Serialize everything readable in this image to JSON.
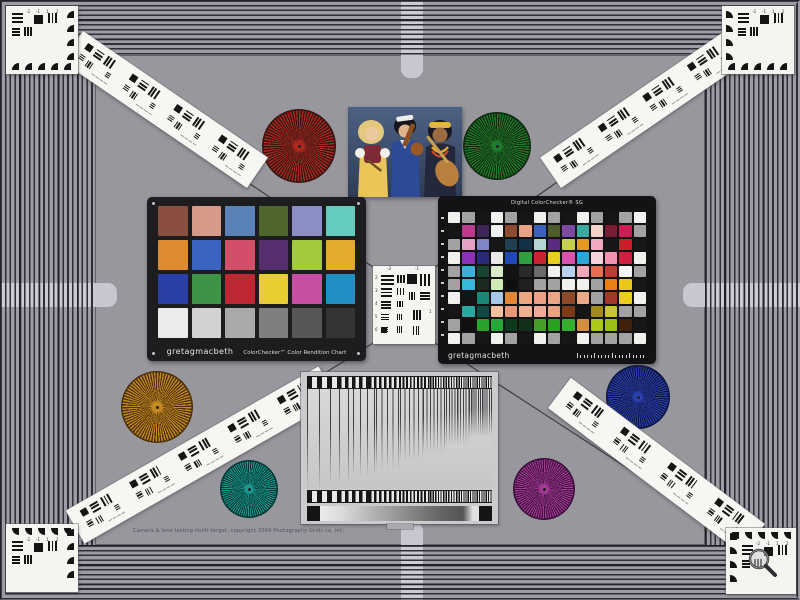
{
  "labels": {
    "cc_brand": "gretagmacbeth",
    "cc_title": "ColorChecker™ Color Rendition Chart",
    "sg_title": "Digital ColorChecker® SG",
    "sg_brand": "gretagmacbeth",
    "copyright": "Camera & lens testing multi-target, copyright 2004 Photography Grids.ca, inc."
  },
  "colors": {
    "field_bg": "#97979d",
    "stripe_dark": "#2e2e38",
    "stripe_light": "#9c9ca4",
    "cross_marker": "#c7c7cf",
    "card_black": "#1d1d1f",
    "guide_line": "#3c3c42"
  },
  "colorchecker": {
    "rows": 4,
    "cols": 6,
    "patches": [
      "#8a4f3f",
      "#d79a88",
      "#5a84b8",
      "#4e6629",
      "#8c8ec6",
      "#63cdbd",
      "#dd8b2e",
      "#3b63c0",
      "#d14f68",
      "#56306e",
      "#a3c93c",
      "#e3ab2c",
      "#2a3fa8",
      "#3d9447",
      "#bf2734",
      "#e8ce30",
      "#c94fa4",
      "#2090c4",
      "#ebebe9",
      "#d2d2d0",
      "#a9a9a9",
      "#7f7f7f",
      "#565656",
      "#343434"
    ]
  },
  "colorchecker_sg": {
    "rows": 10,
    "cols": 14,
    "patches": [
      [
        "#f0f0ec",
        "#a2a2a2",
        "#161616",
        "#f0f0ec",
        "#a2a2a2",
        "#161616",
        "#f0f0ec",
        "#a2a2a2",
        "#161616",
        "#f0f0ec",
        "#a2a2a2",
        "#161616",
        "#a2a2a2",
        "#f0f0ec"
      ],
      [
        "#161616",
        "#bc3a8e",
        "#402656",
        "#f0f0ec",
        "#8c4a2e",
        "#eaa286",
        "#3a62ba",
        "#505c2a",
        "#7c4aa0",
        "#3aaaa0",
        "#f2d2ca",
        "#7a1c34",
        "#cc1e54",
        "#a2a2a2"
      ],
      [
        "#a2a2a2",
        "#e2a2c6",
        "#7e86c8",
        "#161616",
        "#1e4050",
        "#123046",
        "#b6d6d6",
        "#5c2a82",
        "#c6d04a",
        "#e29a20",
        "#f0aac0",
        "#161616",
        "#d01c28",
        "#161616"
      ],
      [
        "#f0f0ec",
        "#8c32ba",
        "#2a2a7a",
        "#e8e8e4",
        "#2148b8",
        "#2ea042",
        "#c82430",
        "#e6d022",
        "#da52aa",
        "#2aa8d8",
        "#f8d2da",
        "#f092b2",
        "#d02042",
        "#f0f0ec"
      ],
      [
        "#a2a2a2",
        "#36b4d8",
        "#164430",
        "#d8eac6",
        "#121212",
        "#2a2a2a",
        "#6a6a6a",
        "#f0f0ec",
        "#b8d2ee",
        "#f2aab8",
        "#e87052",
        "#c03a30",
        "#f6f6f4",
        "#a2a2a2"
      ],
      [
        "#a2a2a2",
        "#38b8d8",
        "#1c2a20",
        "#d2e8b6",
        "#0e0e0e",
        "#202020",
        "#a2a2a2",
        "#a2a2a2",
        "#f0f0ec",
        "#f0f0ec",
        "#a2a2a2",
        "#e88018",
        "#e8c818",
        "#161616"
      ],
      [
        "#f0f0ec",
        "#141414",
        "#1a8878",
        "#a8c8e8",
        "#e08838",
        "#eca882",
        "#eca088",
        "#eca486",
        "#8c4a28",
        "#ecaa8a",
        "#a2a2a2",
        "#a23828",
        "#e8d018",
        "#f0f0ec"
      ],
      [
        "#161616",
        "#2aa8a0",
        "#0e4a42",
        "#f0c0a0",
        "#e89878",
        "#f0b090",
        "#f0a89a",
        "#eca080",
        "#7c3a18",
        "#161616",
        "#a28a1a",
        "#c8c62a",
        "#a2a2a2",
        "#a2a2a2"
      ],
      [
        "#a2a2a2",
        "#101010",
        "#2aa22e",
        "#28a83a",
        "#0c3a1a",
        "#12301a",
        "#46a028",
        "#28a020",
        "#32b02e",
        "#d29040",
        "#aac818",
        "#9ac018",
        "#40200e",
        "#161616"
      ],
      [
        "#f0f0ec",
        "#a2a2a2",
        "#161616",
        "#f0f0ec",
        "#a2a2a2",
        "#161616",
        "#f0f0ec",
        "#a2a2a2",
        "#161616",
        "#f0f0ec",
        "#a2a2a2",
        "#a2a2a2",
        "#a2a2a2",
        "#f0f0ec"
      ]
    ]
  },
  "stars": [
    {
      "name": "star-red",
      "cx": 299,
      "cy": 146,
      "r": 37,
      "color": "#aa2820",
      "dark": "#331410"
    },
    {
      "name": "star-green",
      "cx": 497,
      "cy": 146,
      "r": 34,
      "color": "#1f7d2c",
      "dark": "#10280e"
    },
    {
      "name": "star-orange",
      "cx": 157,
      "cy": 407,
      "r": 36,
      "color": "#c58a22",
      "dark": "#4a3008"
    },
    {
      "name": "star-teal",
      "cx": 249,
      "cy": 489,
      "r": 29,
      "color": "#189a90",
      "dark": "#073430"
    },
    {
      "name": "star-blue",
      "cx": 638,
      "cy": 397,
      "r": 32,
      "color": "#2a3fae",
      "dark": "#0e1440"
    },
    {
      "name": "star-magenta",
      "cx": 544,
      "cy": 489,
      "r": 31,
      "color": "#a63898",
      "dark": "#3a1038"
    }
  ],
  "rulers": [
    {
      "name": "ruler-top-left",
      "cx": 161,
      "cy": 109,
      "len": 216,
      "w": 37,
      "rot": 34.4,
      "modules": 4
    },
    {
      "name": "ruler-top-right",
      "cx": 639,
      "cy": 109,
      "len": 216,
      "w": 37,
      "rot": -34.4,
      "modules": 4
    },
    {
      "name": "ruler-bottom-left",
      "cx": 197,
      "cy": 455,
      "len": 283,
      "w": 38,
      "rot": -29.7,
      "modules": 5
    },
    {
      "name": "ruler-bottom-right",
      "cx": 652,
      "cy": 466,
      "len": 235,
      "w": 38,
      "rot": 37,
      "modules": 4
    }
  ],
  "corner_cards": [
    {
      "name": "corner-target-top-left",
      "x": 6,
      "y": 6,
      "w": 72,
      "h": 68,
      "wh": "bottom",
      "wv": "right"
    },
    {
      "name": "corner-target-top-right",
      "x": 722,
      "y": 6,
      "w": 72,
      "h": 68,
      "wh": "bottom",
      "wv": "left"
    },
    {
      "name": "corner-target-bottom-left",
      "x": 6,
      "y": 524,
      "w": 72,
      "h": 68,
      "wh": "top",
      "wv": "right"
    },
    {
      "name": "corner-target-bottom-right",
      "x": 726,
      "y": 528,
      "w": 70,
      "h": 66,
      "wh": "top",
      "wv": "left"
    }
  ],
  "corner_numbers": [
    "-2",
    "-1",
    "1",
    "2"
  ],
  "usaf_numbers": [
    "-2",
    "-1",
    "2",
    "3",
    "4",
    "5",
    "6",
    "1"
  ],
  "guide_lines": [
    [
      80,
      69,
      373,
      267
    ],
    [
      720,
      69,
      435,
      267
    ],
    [
      82,
      525,
      373,
      343
    ],
    [
      718,
      527,
      435,
      343
    ]
  ],
  "crosses": {
    "top": {
      "band": [
        401,
        0,
        22,
        55
      ],
      "stub": [
        401,
        55,
        22,
        23
      ]
    },
    "bottom": {
      "band": [
        401,
        545,
        22,
        55
      ],
      "stub": [
        401,
        522,
        22,
        23
      ]
    },
    "left": {
      "band": [
        0,
        283,
        95,
        24
      ],
      "stub": [
        95,
        283,
        22,
        24
      ]
    },
    "right": {
      "band": [
        705,
        283,
        95,
        24
      ],
      "stub": [
        683,
        283,
        22,
        24
      ]
    }
  },
  "sweep": {
    "bar_periods": [
      10,
      7,
      5,
      3.6,
      2.6,
      1.8
    ],
    "chirp_periods": [
      12,
      9,
      7,
      5.5,
      4.5,
      3.5,
      2.8,
      2.2
    ],
    "chirp_fades": [
      100,
      95,
      88,
      80,
      72,
      64,
      56,
      48
    ],
    "step_gradient": [
      "#ececec",
      "#d8d8d8",
      "#b0b0b0",
      "#8a8a8a",
      "#666666",
      "#555555",
      "#e0e0e0"
    ]
  }
}
